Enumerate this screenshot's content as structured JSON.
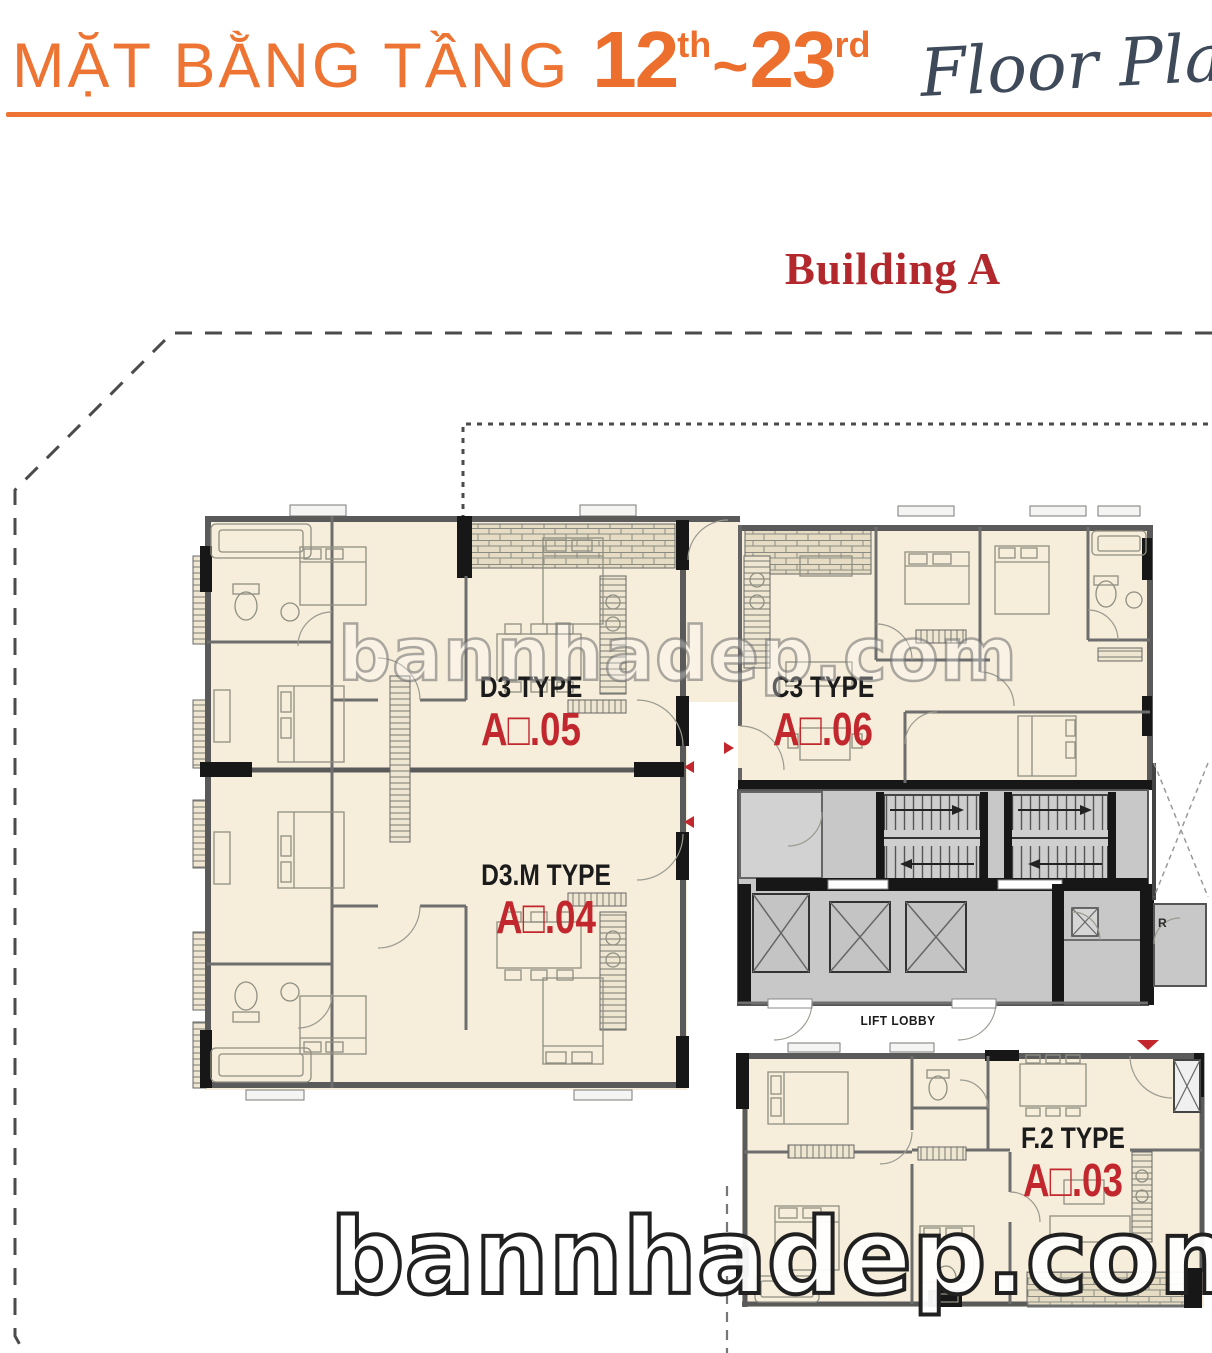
{
  "header": {
    "title_vietnamese": "MẶT BẰNG TẦNG",
    "floor_from": "12",
    "floor_from_ordinal": "th",
    "range_separator": "~",
    "floor_to": "23",
    "floor_to_ordinal": "rd",
    "title_english": "Floor Plan"
  },
  "building_title": "Building A",
  "units": [
    {
      "type_label": "D3 TYPE",
      "unit_number": "A□.05"
    },
    {
      "type_label": "C3 TYPE",
      "unit_number": "A□.06"
    },
    {
      "type_label": "D3.M TYPE",
      "unit_number": "A□.04"
    },
    {
      "type_label": "F.2 TYPE",
      "unit_number": "A□.03"
    }
  ],
  "core_labels": {
    "lift_lobby": "LIFT LOBBY",
    "refuse_room": "R"
  },
  "watermark": {
    "text": "bannhadep.com"
  },
  "icons": {
    "unit-entry-arrow": "small red triangle (corridor entry direction)",
    "main-entrance-arrow": "small red triangle pointing down (F.2 entrance)"
  },
  "colors": {
    "accent_orange": "#ED7433",
    "building_title_red": "#B3282D",
    "unit_number_red": "#C1272D",
    "apartment_fill": "#F6EDDA",
    "core_fill": "#C8C8C8",
    "wall_gray": "#5A5A5A",
    "script_blue_gray": "#3E4A59"
  }
}
